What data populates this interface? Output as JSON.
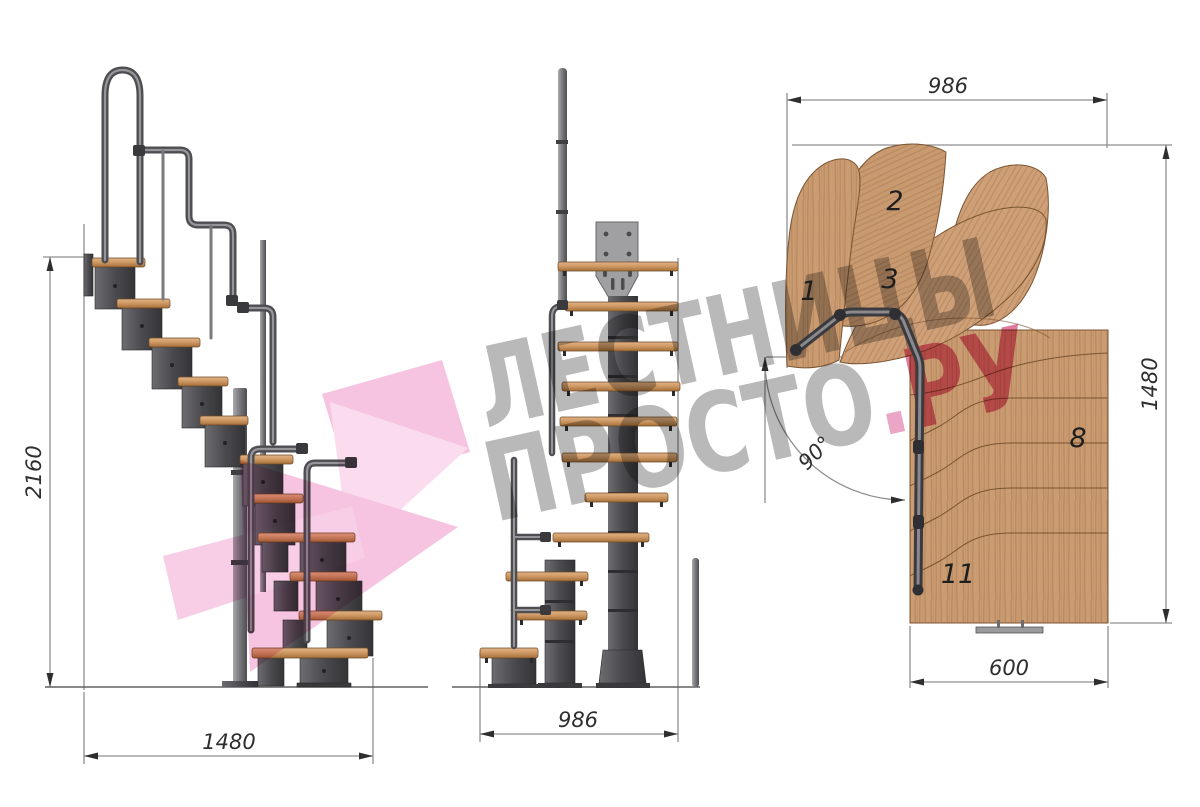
{
  "watermark": {
    "line1": "ЛЕСТНИЦЫ",
    "line2_word": "ПРОСТО",
    "line2_dot": ".",
    "line2_suffix": "РУ"
  },
  "side_view": {
    "height_dim": "2160",
    "width_dim": "1480"
  },
  "front_view": {
    "width_dim": "986"
  },
  "plan_view": {
    "width_dim": "986",
    "depth_dim": "1480",
    "flight_width_dim": "600",
    "angle_dim": "90°",
    "tread_numbers": [
      "1",
      "2",
      "3",
      "8",
      "11"
    ]
  },
  "colors": {
    "wood": "#cb9c72",
    "tread_top": "#d9a877",
    "metal_dark": "#4b4b4f",
    "pole_gray": "#8a8a8e",
    "plate_gray": "#a0a0a3",
    "dimension_line": "#8f8f8f",
    "dimension_text": "#2e2e2e",
    "watermark_gray": "#b9b9b9",
    "watermark_pink": "#e2799f",
    "logo_pink": "#f6c4e0"
  }
}
